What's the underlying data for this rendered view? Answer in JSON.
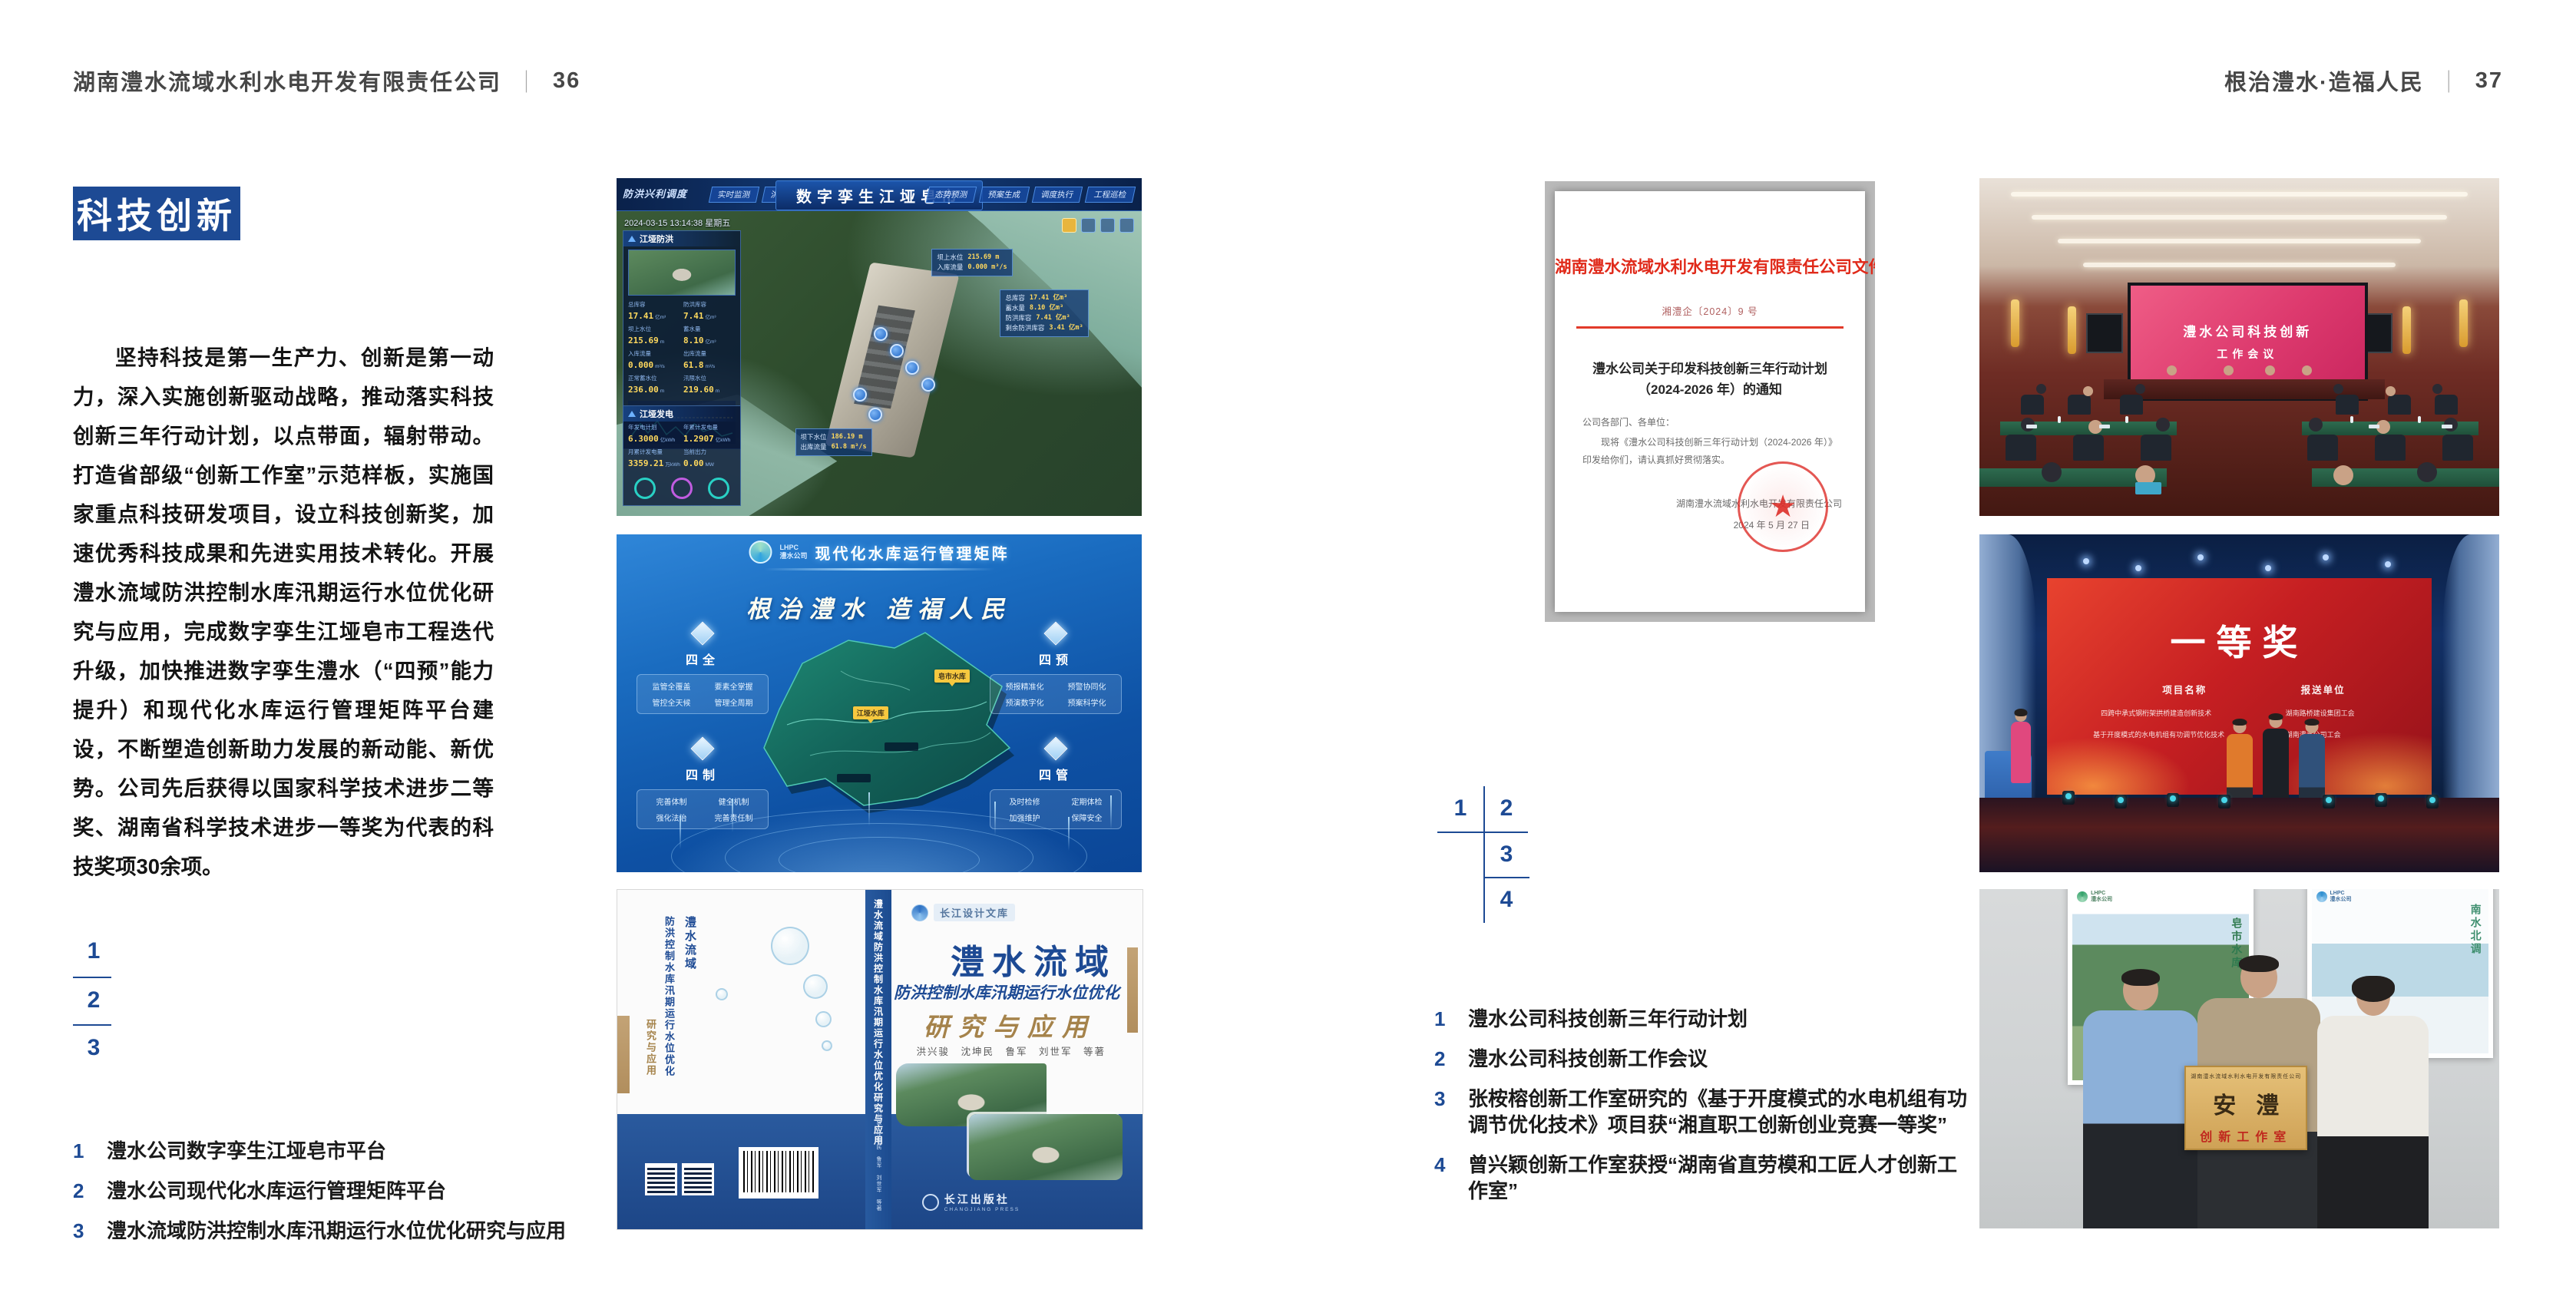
{
  "page": {
    "header_left_title": "湖南澧水流域水利水电开发有限责任公司",
    "header_left_page": "36",
    "header_right_title": "根治澧水·造福人民",
    "header_right_page": "37",
    "separator": "｜"
  },
  "section_badge": "科技创新",
  "intro_text": "坚持科技是第一生产力、创新是第一动力，深入实施创新驱动战略，推动落实科技创新三年行动计划，以点带面，辐射带动。打造省部级“创新工作室”示范样板，实施国家重点科技研发项目，设立科技创新奖，加速优秀科技成果和先进实用技术转化。开展澧水流域防洪控制水库汛期运行水位优化研究与应用，完成数字孪生江垭皂市工程迭代升级，加快推进数字孪生澧水（“四预”能力提升）和现代化水库运行管理矩阵平台建设，不断塑造创新助力发展的新动能、新优势。公司先后获得以国家科学技术进步二等奖、湖南省科学技术进步一等奖为代表的科技奖项30余项。",
  "left_figs": {
    "n1": "1",
    "n2": "2",
    "n3": "3",
    "captions": [
      {
        "no": "1",
        "text": "澧水公司数字孪生江垭皂市平台"
      },
      {
        "no": "2",
        "text": "澧水公司现代化水库运行管理矩阵平台"
      },
      {
        "no": "3",
        "text": "澧水流域防洪控制水库汛期运行水位优化研究与应用"
      }
    ]
  },
  "right_figs": {
    "n1": "1",
    "n2": "2",
    "n3": "3",
    "n4": "4",
    "captions": [
      {
        "no": "1",
        "text": "澧水公司科技创新三年行动计划"
      },
      {
        "no": "2",
        "text": "澧水公司科技创新工作会议"
      },
      {
        "no": "3",
        "text": "张桉榕创新工作室研究的《基于开度模式的水电机组有功调节优化技术》项目获“湘直职工创新创业竞赛一等奖”"
      },
      {
        "no": "4",
        "text": "曾兴颖创新工作室获授“湖南省直劳模和工匠人才创新工作室”"
      }
    ]
  },
  "fig_dt": {
    "corner_label": "防洪兴利调度",
    "title": "数字孪生江垭皂市",
    "datetime": "2024-03-15 13:14:38 星期五",
    "tabs_left": [
      "实时监测",
      "洪水预报",
      "防洪预警"
    ],
    "tabs_right": [
      "态势预测",
      "预案生成",
      "调度执行",
      "工程巡检"
    ],
    "panel_flood": {
      "title": "江垭防洪",
      "stats": [
        {
          "l": "总库容",
          "v": "17.41",
          "u": "亿m³"
        },
        {
          "l": "防洪库容",
          "v": "7.41",
          "u": "亿m³"
        },
        {
          "l": "坝上水位",
          "v": "215.69",
          "u": "m"
        },
        {
          "l": "蓄水量",
          "v": "8.10",
          "u": "亿m³"
        },
        {
          "l": "入库流量",
          "v": "0.000",
          "u": "m³/s"
        },
        {
          "l": "出库流量",
          "v": "61.8",
          "u": "m³/s"
        },
        {
          "l": "正常蓄水位",
          "v": "236.00",
          "u": "m"
        },
        {
          "l": "汛限水位",
          "v": "219.60",
          "u": "m"
        }
      ]
    },
    "panel_power": {
      "title": "江垭发电",
      "stats": [
        {
          "l": "年发电计划",
          "v": "6.3000",
          "u": "亿kWh"
        },
        {
          "l": "年累计发电量",
          "v": "1.2907",
          "u": "亿kWh"
        },
        {
          "l": "月累计发电量",
          "v": "3359.21",
          "u": "万kWh"
        },
        {
          "l": "当前出力",
          "v": "0.00",
          "u": "MW"
        }
      ]
    },
    "tip_up": {
      "l1": "坝上水位",
      "v1": "215.69 m",
      "l2": "入库流量",
      "v2": "0.000 m³/s"
    },
    "tip_res": {
      "l1": "总库容",
      "v1": "17.41 亿m³",
      "l2": "蓄水量",
      "v2": "8.10 亿m³",
      "l3": "防洪库容",
      "v3": "7.41 亿m³",
      "l4": "剩余防洪库容",
      "v4": "3.41 亿m³"
    },
    "tip_down": {
      "l1": "坝下水位",
      "v1": "186.19 m",
      "l2": "出库流量",
      "v2": "61.8 m³/s"
    }
  },
  "fig_mx": {
    "logo_line1": "LHPC",
    "logo_line2": "澧水公司",
    "title": "现代化水库运行管理矩阵",
    "slogan": "根治澧水 造福人民",
    "panels": [
      {
        "name": "四全",
        "items": [
          "监管全覆盖",
          "要素全掌握",
          "管控全天候",
          "管理全周期"
        ]
      },
      {
        "name": "四预",
        "items": [
          "预报精准化",
          "预警协同化",
          "预演数字化",
          "预案科学化"
        ]
      },
      {
        "name": "四制",
        "items": [
          "完善体制",
          "健全机制",
          "强化法治",
          "完善责任制"
        ]
      },
      {
        "name": "四管",
        "items": [
          "及时检修",
          "定期体检",
          "加强维护",
          "保障安全"
        ]
      }
    ],
    "marker1": "皂市水库",
    "marker2": "江垭水库"
  },
  "fig_book": {
    "series": "长江设计文库",
    "back_title_1": "澧水流域",
    "back_title_2": "防洪控制水库汛期运行水位优化",
    "back_title_3": "研究与应用",
    "spine_title": "澧水流域防洪控制水库汛期运行水位优化研究与应用",
    "spine_authors": "洪兴骏 沈坤民 鲁军 刘世军 等著",
    "title_line1": "澧水流域",
    "title_line2": "防洪控制水库汛期运行水位优化",
    "title_line3": "研究与应用",
    "authors": "洪兴骏　沈坤民　鲁军　刘世军　等著",
    "publisher": "长江出版社",
    "publisher_en": "CHANGJIANG PRESS"
  },
  "fig_doc": {
    "header": "湖南澧水流域水利水电开发有限责任公司文件",
    "doc_no": "湘澧企〔2024〕9 号",
    "title_line1": "澧水公司关于印发科技创新三年行动计划",
    "title_line2": "（2024-2026 年）的通知",
    "salutation": "公司各部门、各单位：",
    "body": "现将《澧水公司科技创新三年行动计划（2024-2026 年）》印发给你们，请认真抓好贯彻落实。",
    "signature": "湖南澧水流域水利水电开发有限责任公司",
    "date": "2024 年 5 月 27 日",
    "seal_star": "★"
  },
  "fig_meeting": {
    "screen_line1": "澧水公司科技创新",
    "screen_line2": "工作会议"
  },
  "fig_award": {
    "title": "一等奖",
    "col1": "项目名称",
    "col2": "报送单位",
    "row1_project": "四跨中承式钢桁架拱桥建造创新技术",
    "row1_org": "湖南路桥建设集团工会",
    "row2_project": "基于开度模式的水电机组有功调节优化技术",
    "row2_org": "湖南澧水公司工会"
  },
  "fig_group": {
    "plaque_top": "湖南澧水流域水利水电开发有限责任公司",
    "plaque_main": "安澧",
    "plaque_sub": "创新工作室",
    "poster1_vtext": "皂市水库",
    "poster2_vtext": "南水北调",
    "logo1": "LHPC",
    "logo2": "澧水公司"
  }
}
